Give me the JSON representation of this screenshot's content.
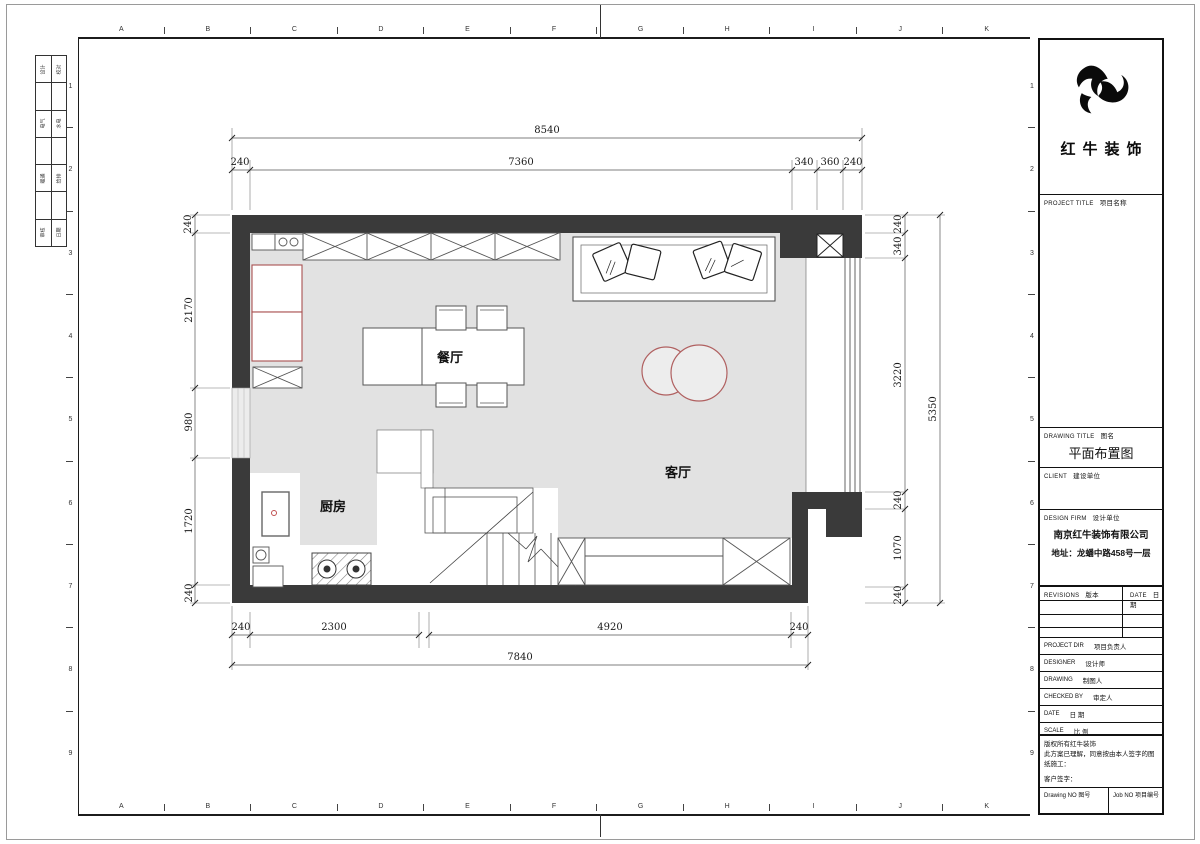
{
  "page": {
    "rulers": {
      "letters": [
        "A",
        "B",
        "C",
        "D",
        "E",
        "F",
        "G",
        "H",
        "I",
        "J",
        "K"
      ],
      "numbers": [
        "1",
        "2",
        "3",
        "4",
        "5",
        "6",
        "7",
        "8",
        "9"
      ]
    },
    "side_index": {
      "rows": [
        {
          "l": "设计",
          "r": "校对"
        },
        {
          "l": "电气",
          "r": "水电"
        },
        {
          "l": "暖通",
          "r": "给排"
        },
        {
          "l": "审核",
          "r": "日期"
        }
      ]
    }
  },
  "plan": {
    "rooms": {
      "dining": "餐厅",
      "living": "客厅",
      "kitchen": "厨房"
    },
    "dims": {
      "top": {
        "total": "8540",
        "segments": [
          "240",
          "7360",
          "340",
          "360",
          "240"
        ]
      },
      "left": {
        "segments": [
          "240",
          "2170",
          "980",
          "1720",
          "240"
        ]
      },
      "right": {
        "total": "5350",
        "segments": [
          "240",
          "340",
          "3220",
          "240",
          "1070",
          "240"
        ]
      },
      "bottom": {
        "total": "7840",
        "segments": [
          "240",
          "2300",
          "4920",
          "240"
        ]
      }
    }
  },
  "titleblock": {
    "logo_text": "红牛装饰",
    "project_title": {
      "en": "PROJECT TITLE",
      "cn": "项目名称"
    },
    "drawing_title": {
      "en": "DRAWING TITLE",
      "cn": "图名",
      "value": "平面布置图"
    },
    "client": {
      "en": "CLIENT",
      "cn": "建设单位"
    },
    "design_firm": {
      "en": "DESIGN FIRM",
      "cn": "设计单位",
      "company": "南京红牛装饰有限公司",
      "address": "地址：龙蟠中路458号一层"
    },
    "revisions": {
      "en": "REVISIONS",
      "cn": "版本",
      "date_en": "DATE",
      "date_cn": "日期"
    },
    "rows": [
      {
        "en": "PROJECT DIR",
        "cn": "项目负责人"
      },
      {
        "en": "DESIGNER",
        "cn": "设计师"
      },
      {
        "en": "DRAWING",
        "cn": "制图人"
      },
      {
        "en": "CHECKED BY",
        "cn": "审定人"
      },
      {
        "en": "DATE",
        "cn": "日  期"
      },
      {
        "en": "SCALE",
        "cn": "比  例"
      }
    ],
    "copyright": {
      "line1": "版权所有红牛装饰",
      "line2": "此方案已理解，同意按由本人签字的图纸施工：",
      "line3": "客户签字："
    },
    "footer": {
      "drawing_no_en": "Drawing NO",
      "drawing_no_cn": "图号",
      "job_no_en": "Job NO",
      "job_no_cn": "项目编号"
    }
  }
}
